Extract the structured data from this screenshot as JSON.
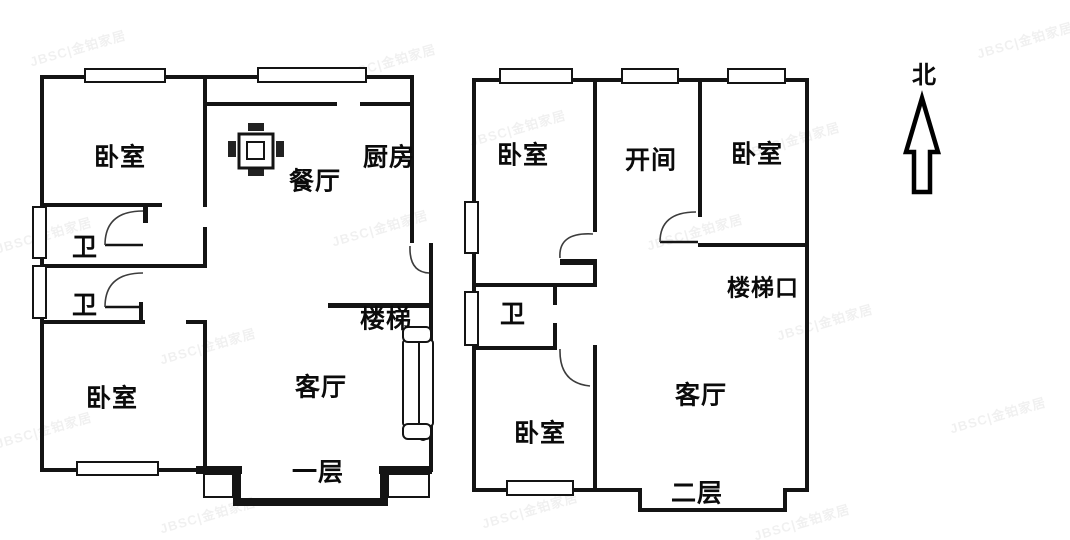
{
  "page": {
    "background_color": "#ffffff",
    "wall_color": "#141414",
    "door_arc_color": "#3c3c3c"
  },
  "watermark": {
    "text": "JBSC|金铂家居"
  },
  "compass": {
    "label": "北"
  },
  "floor1": {
    "rooms": {
      "bedroom_top": "卧室",
      "dining": "餐厅",
      "kitchen": "厨房",
      "bath_1": "卫",
      "bath_2": "卫",
      "stairs": "楼梯",
      "bedroom_bottom": "卧室",
      "living": "客厅",
      "floor_label": "一层"
    }
  },
  "floor2": {
    "rooms": {
      "bedroom_top_left": "卧室",
      "open_bay": "开间",
      "bedroom_top_right": "卧室",
      "stair_opening": "楼梯口",
      "bath": "卫",
      "bedroom_bottom": "卧室",
      "living": "客厅",
      "floor_label": "二层"
    }
  }
}
